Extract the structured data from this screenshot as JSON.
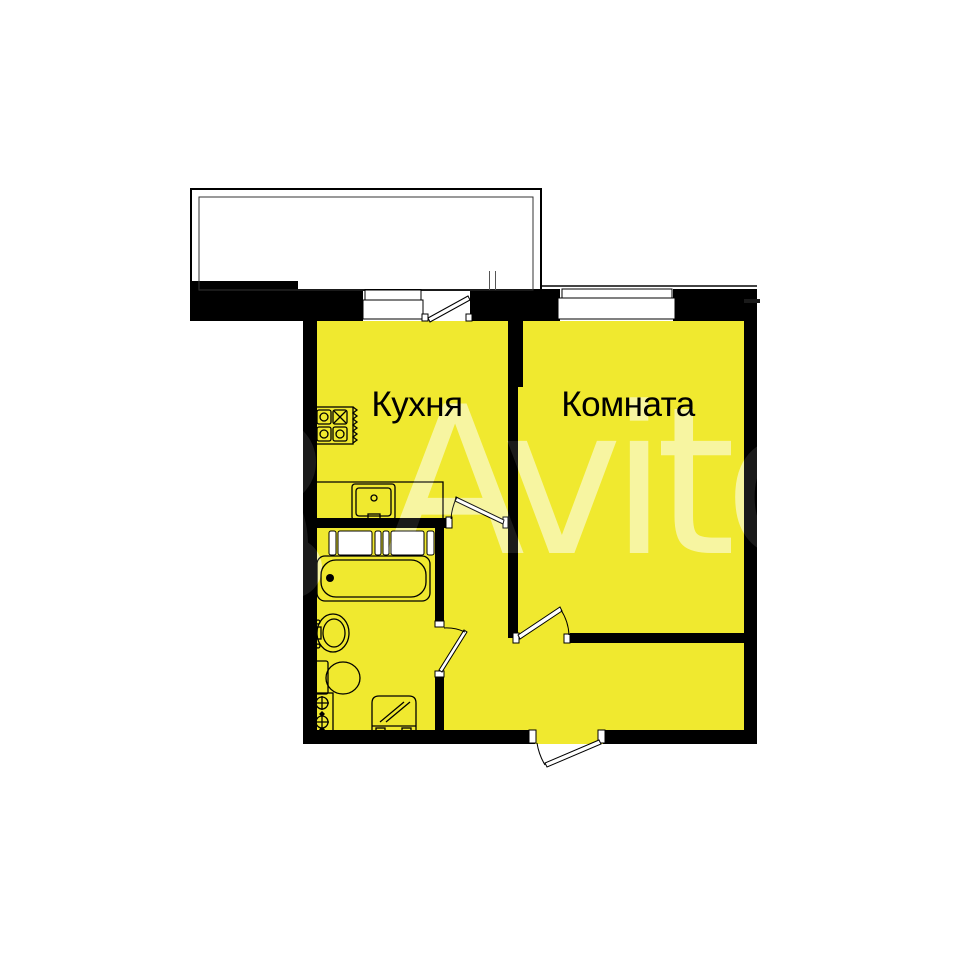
{
  "watermark": {
    "text": "Avito",
    "color": "#ffffff"
  },
  "plan": {
    "floor_color": "#F0E92F",
    "wall_color": "#000000",
    "line_color": "#000000",
    "rooms": [
      {
        "name": "kitchen",
        "label": "Кухня"
      },
      {
        "name": "room",
        "label": "Комната"
      }
    ],
    "areas": [
      "balcony",
      "bathroom",
      "hallway"
    ],
    "openings": [
      "balcony-door",
      "kitchen-door",
      "bathroom-door",
      "room-door",
      "entrance-door",
      "kitchen-window",
      "room-window"
    ],
    "fixtures": [
      "stove",
      "kitchen-sink",
      "counter",
      "shower-screen",
      "bathtub",
      "washbasin",
      "toilet",
      "water-riser",
      "washing-machine"
    ]
  }
}
